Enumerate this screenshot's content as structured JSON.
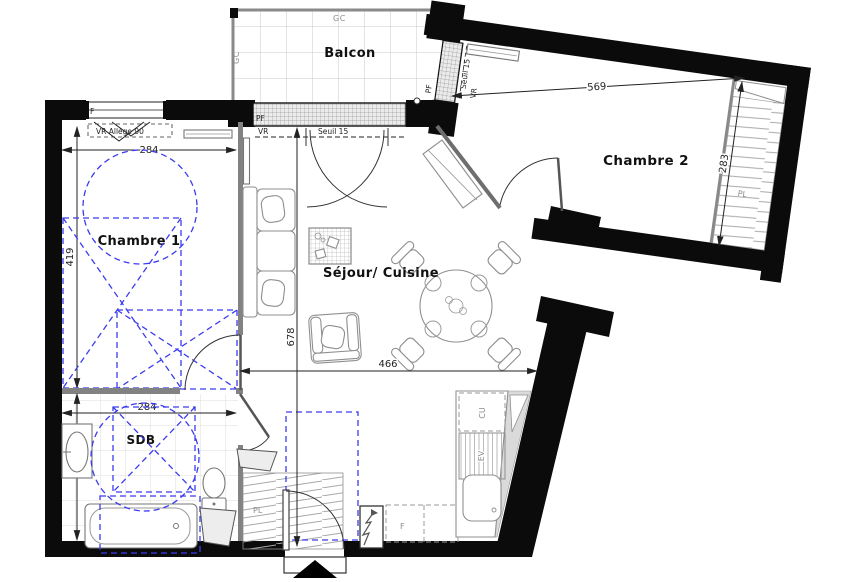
{
  "plan": {
    "rooms": {
      "balcon": "Balcon",
      "chambre1": "Chambre 1",
      "chambre2": "Chambre 2",
      "sejour": "Séjour/ Cuisine",
      "sdb": "SDB"
    },
    "dims": {
      "ch1_w": "284",
      "ch1_d": "419",
      "sdb_w": "284",
      "sdb_d": "252",
      "sej_w": "466",
      "sej_d": "678",
      "ch2_w": "569",
      "ch2_d": "283"
    },
    "ann": {
      "gc": "GC",
      "pf": "PF",
      "vr": "VR",
      "seuil": "Seuil 15",
      "allege": "VR Allège 90",
      "window_f": "F",
      "pl": "PL",
      "cu": "CU",
      "ev": "EV",
      "fridge_f": "F"
    },
    "colors": {
      "wall": "#0b0b0b",
      "overlay_blue": "#3b3bf0",
      "furniture_gray": "#8f8f8f",
      "tile_gray": "#c9c9c9"
    }
  }
}
